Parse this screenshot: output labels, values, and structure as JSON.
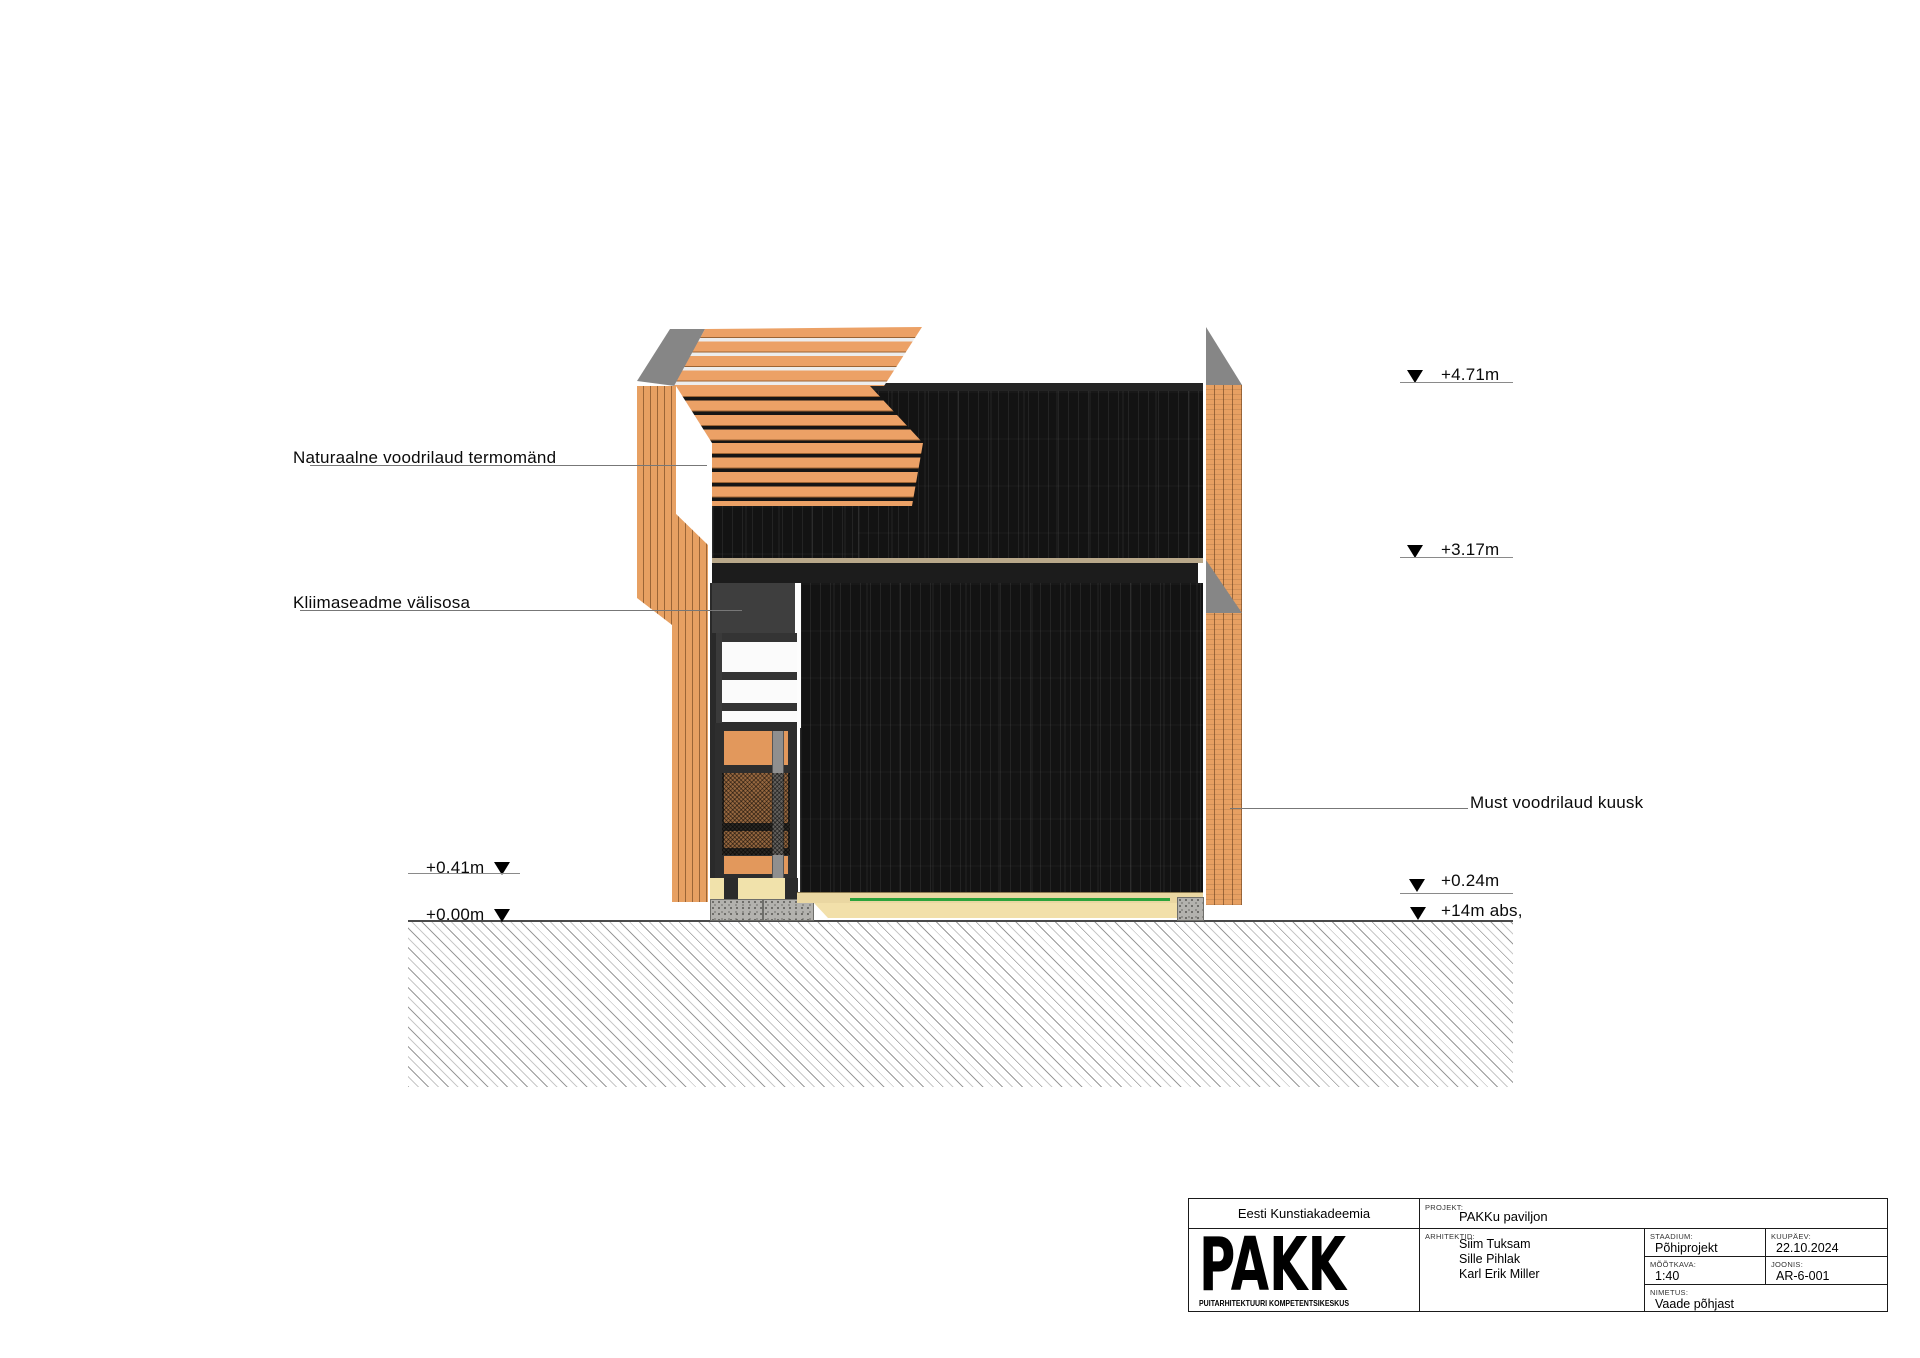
{
  "drawing": {
    "annotations": {
      "cladding_pine": "Naturaalne voodrilaud termomänd",
      "hvac_unit": "Kliimaseadme välisosa",
      "cladding_spruce": "Must voodrilaud kuusk"
    },
    "elevation_markers": {
      "right_top": "+4.71m",
      "right_mid": "+3.17m",
      "right_low": "+0.24m",
      "right_ground": "+14m abs,",
      "left_upper": "+0.41m",
      "left_ground": "+0.00m"
    }
  },
  "title_block": {
    "organization": "Eesti Kunstiakadeemia",
    "logo_text": "PAKK",
    "logo_caption": "PUITARHITEKTUURI KOMPETENTSIKESKUS",
    "project_label": "PROJEKT:",
    "project": "PAKKu paviljon",
    "architects_label": "ARHITEKTID:",
    "architects": [
      "Siim Tuksam",
      "Sille Pihlak",
      "Karl Erik Miller"
    ],
    "stage_label": "STAADIUM:",
    "stage": "Põhiprojekt",
    "date_label": "KUUPÄEV:",
    "date": "22.10.2024",
    "scale_label": "MÕÕTKAVA:",
    "scale": "1:40",
    "sheet_label": "JOONIS:",
    "sheet": "AR-6-001",
    "name_label": "NIMETUS:",
    "name": "Vaade põhjast"
  },
  "colors": {
    "wood_orange": "#e7a062",
    "charred_black": "#141414",
    "roof_gray": "#868686",
    "foundation_yellow": "#f1e2ab",
    "plinth_green": "#2ca33b",
    "gravel_gray": "#b3b2ae"
  }
}
